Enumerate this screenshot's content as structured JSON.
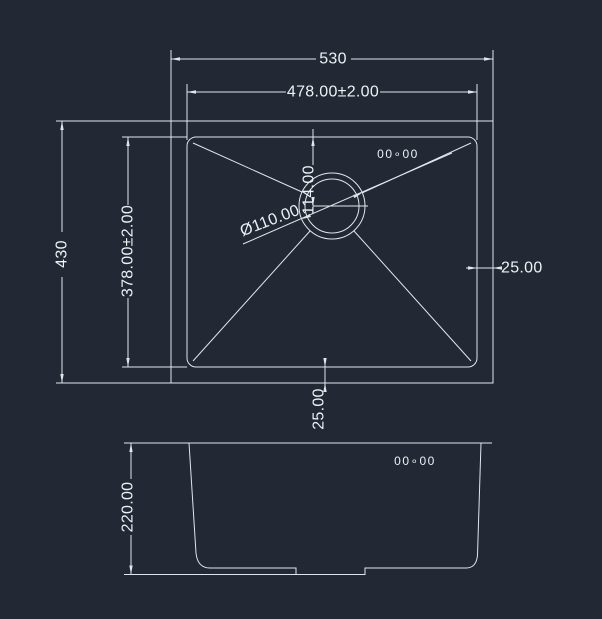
{
  "drawing": {
    "type": "cad-sink-drawing",
    "colors": {
      "background": "#222834",
      "line": "#e2e6ec",
      "text": "#eef1f5"
    },
    "top_view": {
      "dim_width_outer": "530",
      "dim_width_inner": "478.00±2.00",
      "dim_height_outer": "430",
      "dim_height_inner": "378.00±2.00",
      "dim_right_offset": "25.00",
      "dim_bottom_offset": "25.00",
      "dim_drain_diameter": "Ø110.00",
      "dim_drain_center_from_rim": "114.00",
      "surface_mark": "00∘00"
    },
    "front_view": {
      "dim_depth": "220.00",
      "surface_mark": "00∘00"
    }
  }
}
